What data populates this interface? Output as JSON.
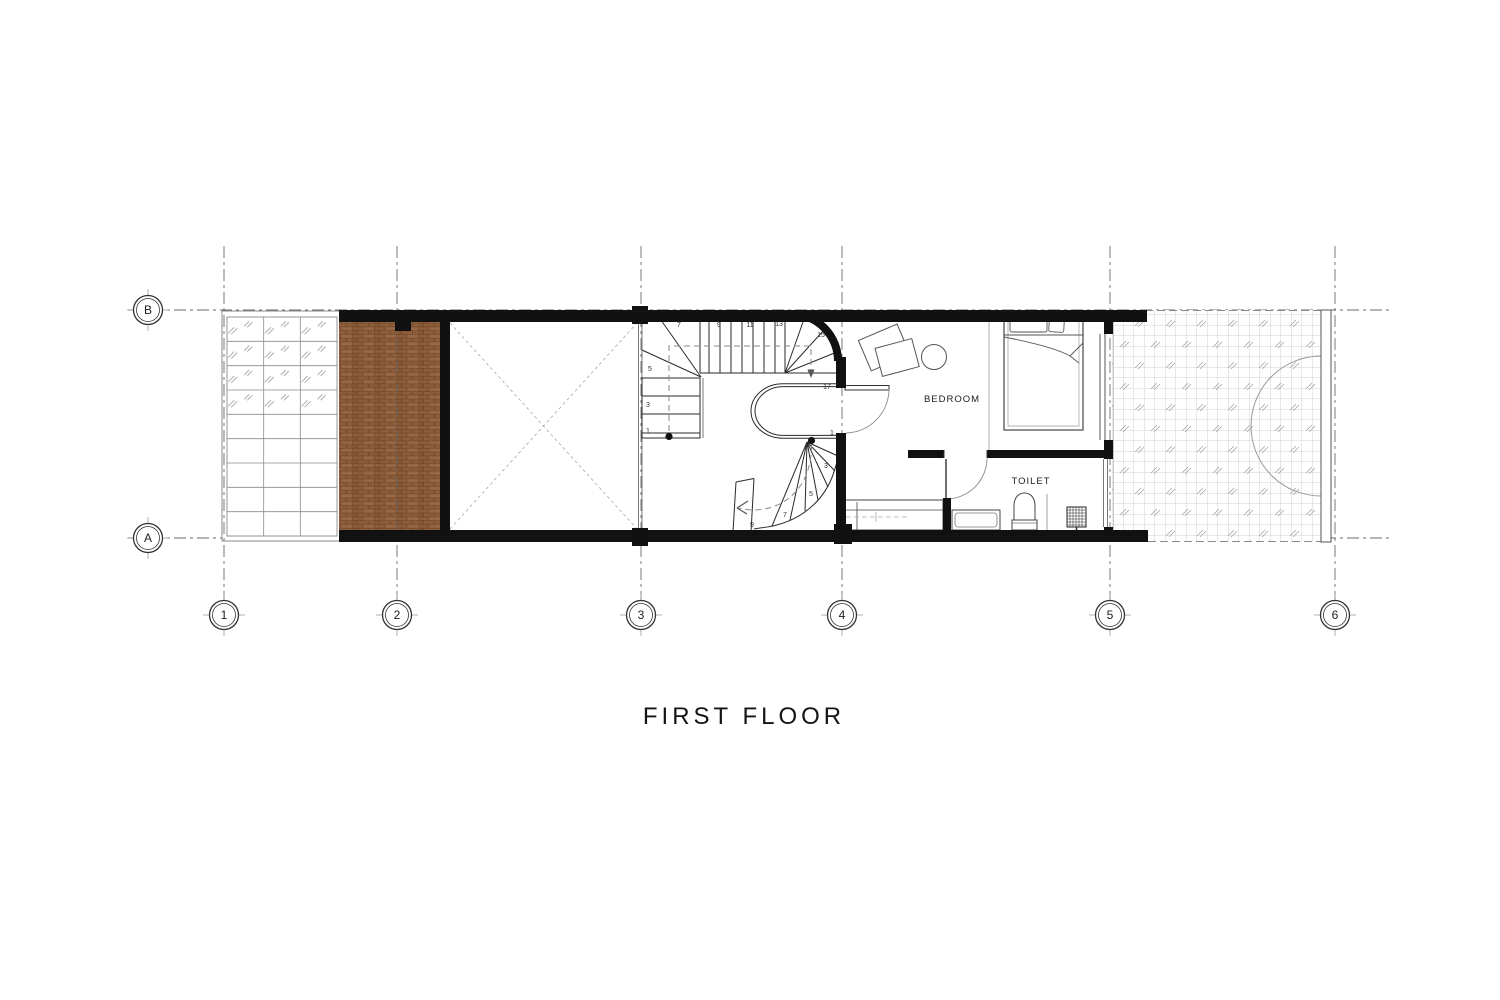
{
  "title": "FIRST FLOOR",
  "rooms": {
    "bedroom": "BEDROOM",
    "toilet": "TOILET"
  },
  "grid": {
    "columns": [
      "1",
      "2",
      "3",
      "4",
      "5",
      "6"
    ],
    "rows": [
      "B",
      "A"
    ]
  },
  "stairs": {
    "upper_numbers": [
      "1",
      "3",
      "5",
      "7",
      "9",
      "11",
      "13",
      "15",
      "17"
    ],
    "lower_numbers": [
      "1",
      "3",
      "5",
      "7",
      "9"
    ]
  },
  "colors": {
    "wall": "#111111",
    "deck_wood": "#8d5c38",
    "deck_joint": "#6f4527",
    "drawing_line": "#2a2a2a",
    "grid_line": "#6a6a6a",
    "tile_line": "#cccccc",
    "glass_mark": "#9a9a9a"
  }
}
